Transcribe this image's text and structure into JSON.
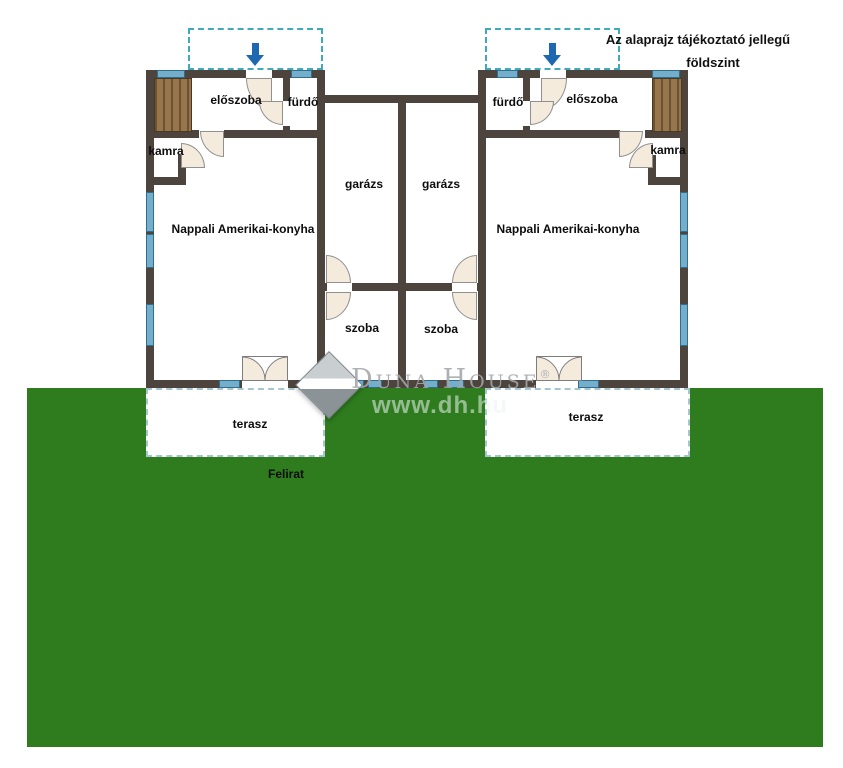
{
  "annotation": {
    "line1": "Az alaprajz tájékoztató jellegű",
    "line2": "földszint"
  },
  "caption": "Felirat",
  "watermark": {
    "brand": "Duna House",
    "registered": "®",
    "url": "www.dh.hu"
  },
  "rooms": {
    "left": {
      "eloszoba": "előszoba",
      "furdo": "fürdő",
      "kamra": "kamra",
      "nappali": "Nappali Amerikai-konyha",
      "garazs": "garázs",
      "szoba": "szoba",
      "terasz": "terasz"
    },
    "right": {
      "eloszoba": "előszoba",
      "furdo": "fürdő",
      "kamra": "kamra",
      "nappali": "Nappali Amerikai-konyha",
      "garazs": "garázs",
      "szoba": "szoba",
      "terasz": "terasz"
    }
  },
  "colors": {
    "wall": "#4d443e",
    "window": "#74aecb",
    "lawn": "#2f7c1f",
    "entry_dash": "#3fa9bd",
    "arrow": "#1e68b2",
    "stairs": "#8f6d46",
    "door": "#f4ebdd",
    "terrace_dash": "#a5c6ce"
  }
}
